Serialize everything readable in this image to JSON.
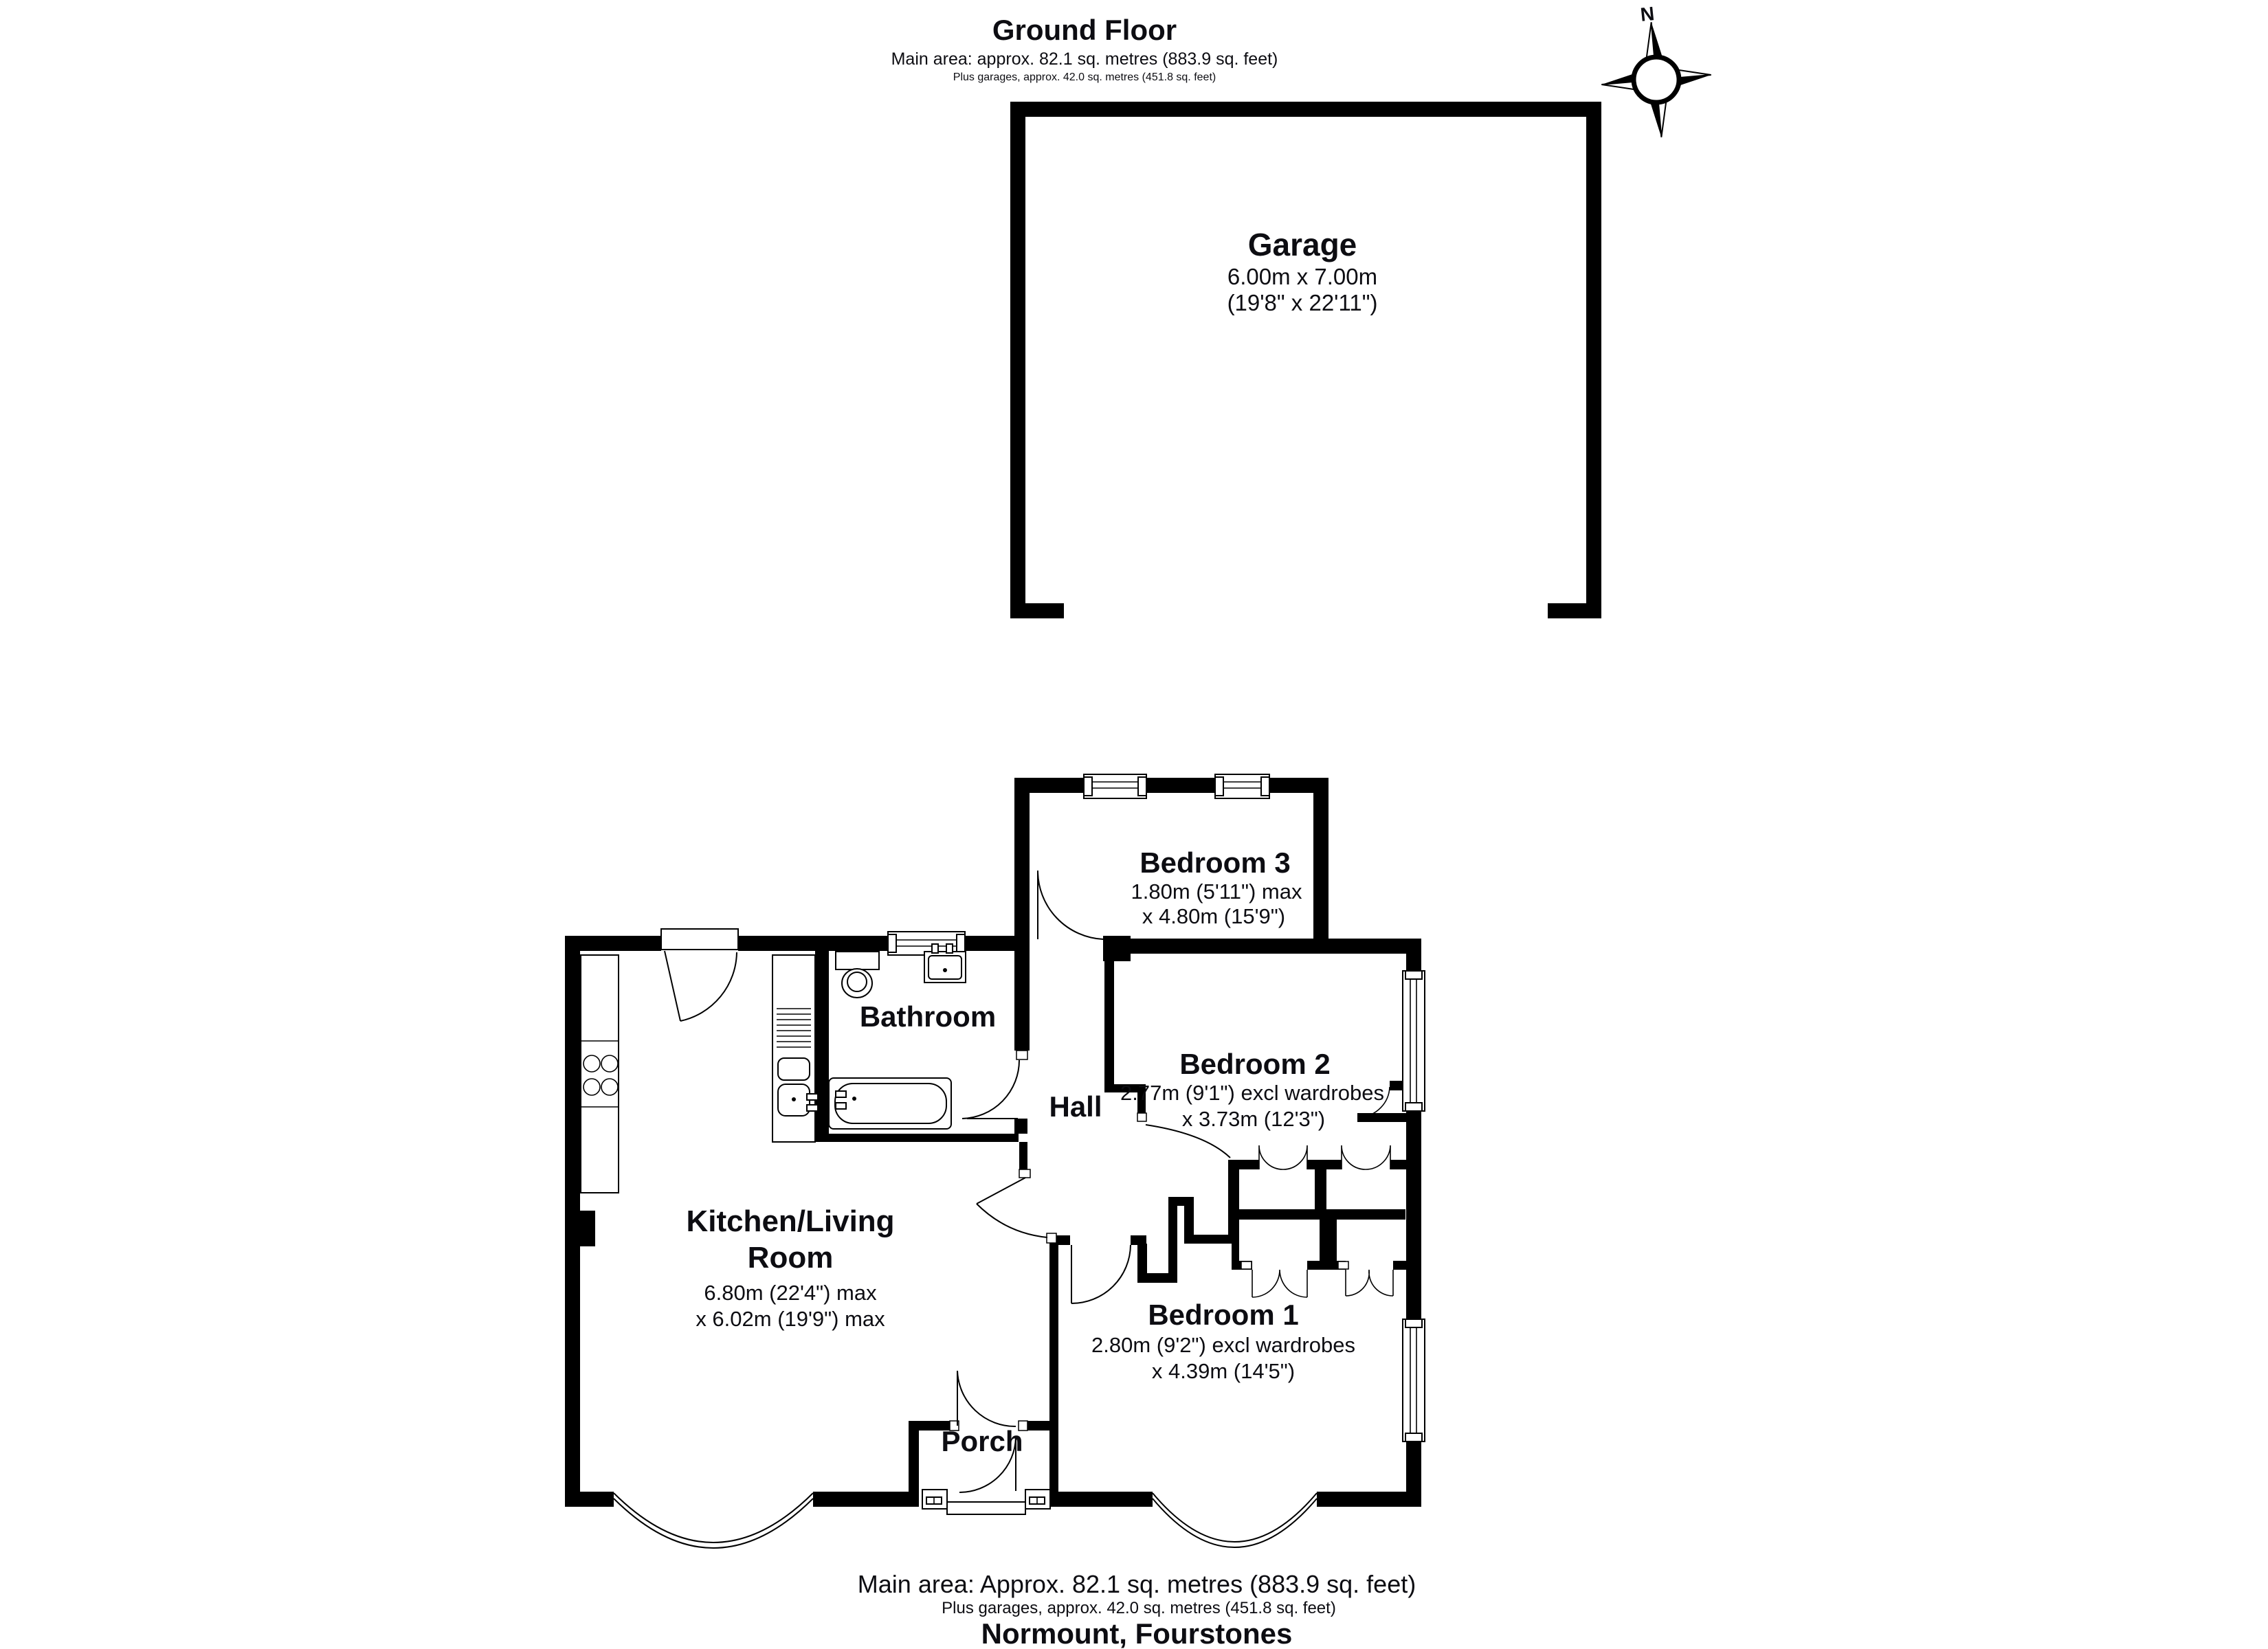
{
  "header": {
    "title": "Ground Floor",
    "subtitle": "Main area: approx. 82.1 sq. metres (883.9 sq. feet)",
    "subtitle2": "Plus garages, approx. 42.0 sq. metres (451.8 sq. feet)"
  },
  "compass": {
    "north_label": "N"
  },
  "garage": {
    "name": "Garage",
    "dim_metric": "6.00m x 7.00m",
    "dim_imperial": "(19'8\" x 22'11\")"
  },
  "rooms": {
    "bedroom3": {
      "name": "Bedroom 3",
      "dim1": "1.80m (5'11\") max",
      "dim2": "x 4.80m (15'9\")"
    },
    "bedroom2": {
      "name": "Bedroom 2",
      "dim1": "2.77m (9'1\") excl wardrobes",
      "dim2": "x 3.73m (12'3\")"
    },
    "bathroom": {
      "name": "Bathroom"
    },
    "hall": {
      "name": "Hall"
    },
    "kitchen_living": {
      "name_line1": "Kitchen/Living",
      "name_line2": "Room",
      "dim1": "6.80m (22'4\") max",
      "dim2": "x 6.02m (19'9\") max"
    },
    "bedroom1": {
      "name": "Bedroom 1",
      "dim1": "2.80m (9'2\") excl wardrobes",
      "dim2": "x 4.39m (14'5\")"
    },
    "porch": {
      "name": "Porch"
    }
  },
  "footer": {
    "line1": "Main area: Approx. 82.1 sq. metres (883.9 sq. feet)",
    "line2": "Plus garages, approx. 42.0 sq. metres (451.8 sq. feet)",
    "line3": "Normount, Fourstones"
  },
  "colors": {
    "wall": "#000000",
    "text": "#0d0d12",
    "background": "#ffffff"
  }
}
